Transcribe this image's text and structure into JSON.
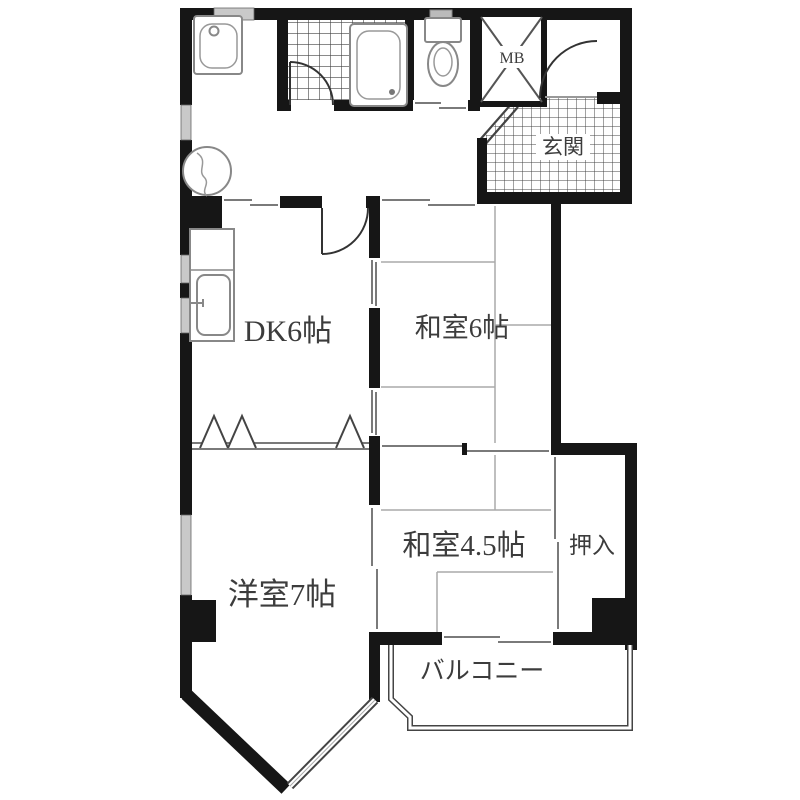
{
  "floorplan": {
    "title": "apartment-floorplan",
    "rooms": {
      "mb": "MB",
      "genkan": "玄関",
      "dk": "DK6帖",
      "washitsu6": "和室6帖",
      "washitsu45": "和室4.5帖",
      "oshiire": "押入",
      "yoshitsu": "洋室7帖",
      "balcony": "バルコニー"
    },
    "colors": {
      "wall": "#161616",
      "fixture_line": "#888888",
      "label_text": "#3c3c3c",
      "tatami_line": "#aaaaaa",
      "background": "#ffffff"
    }
  }
}
